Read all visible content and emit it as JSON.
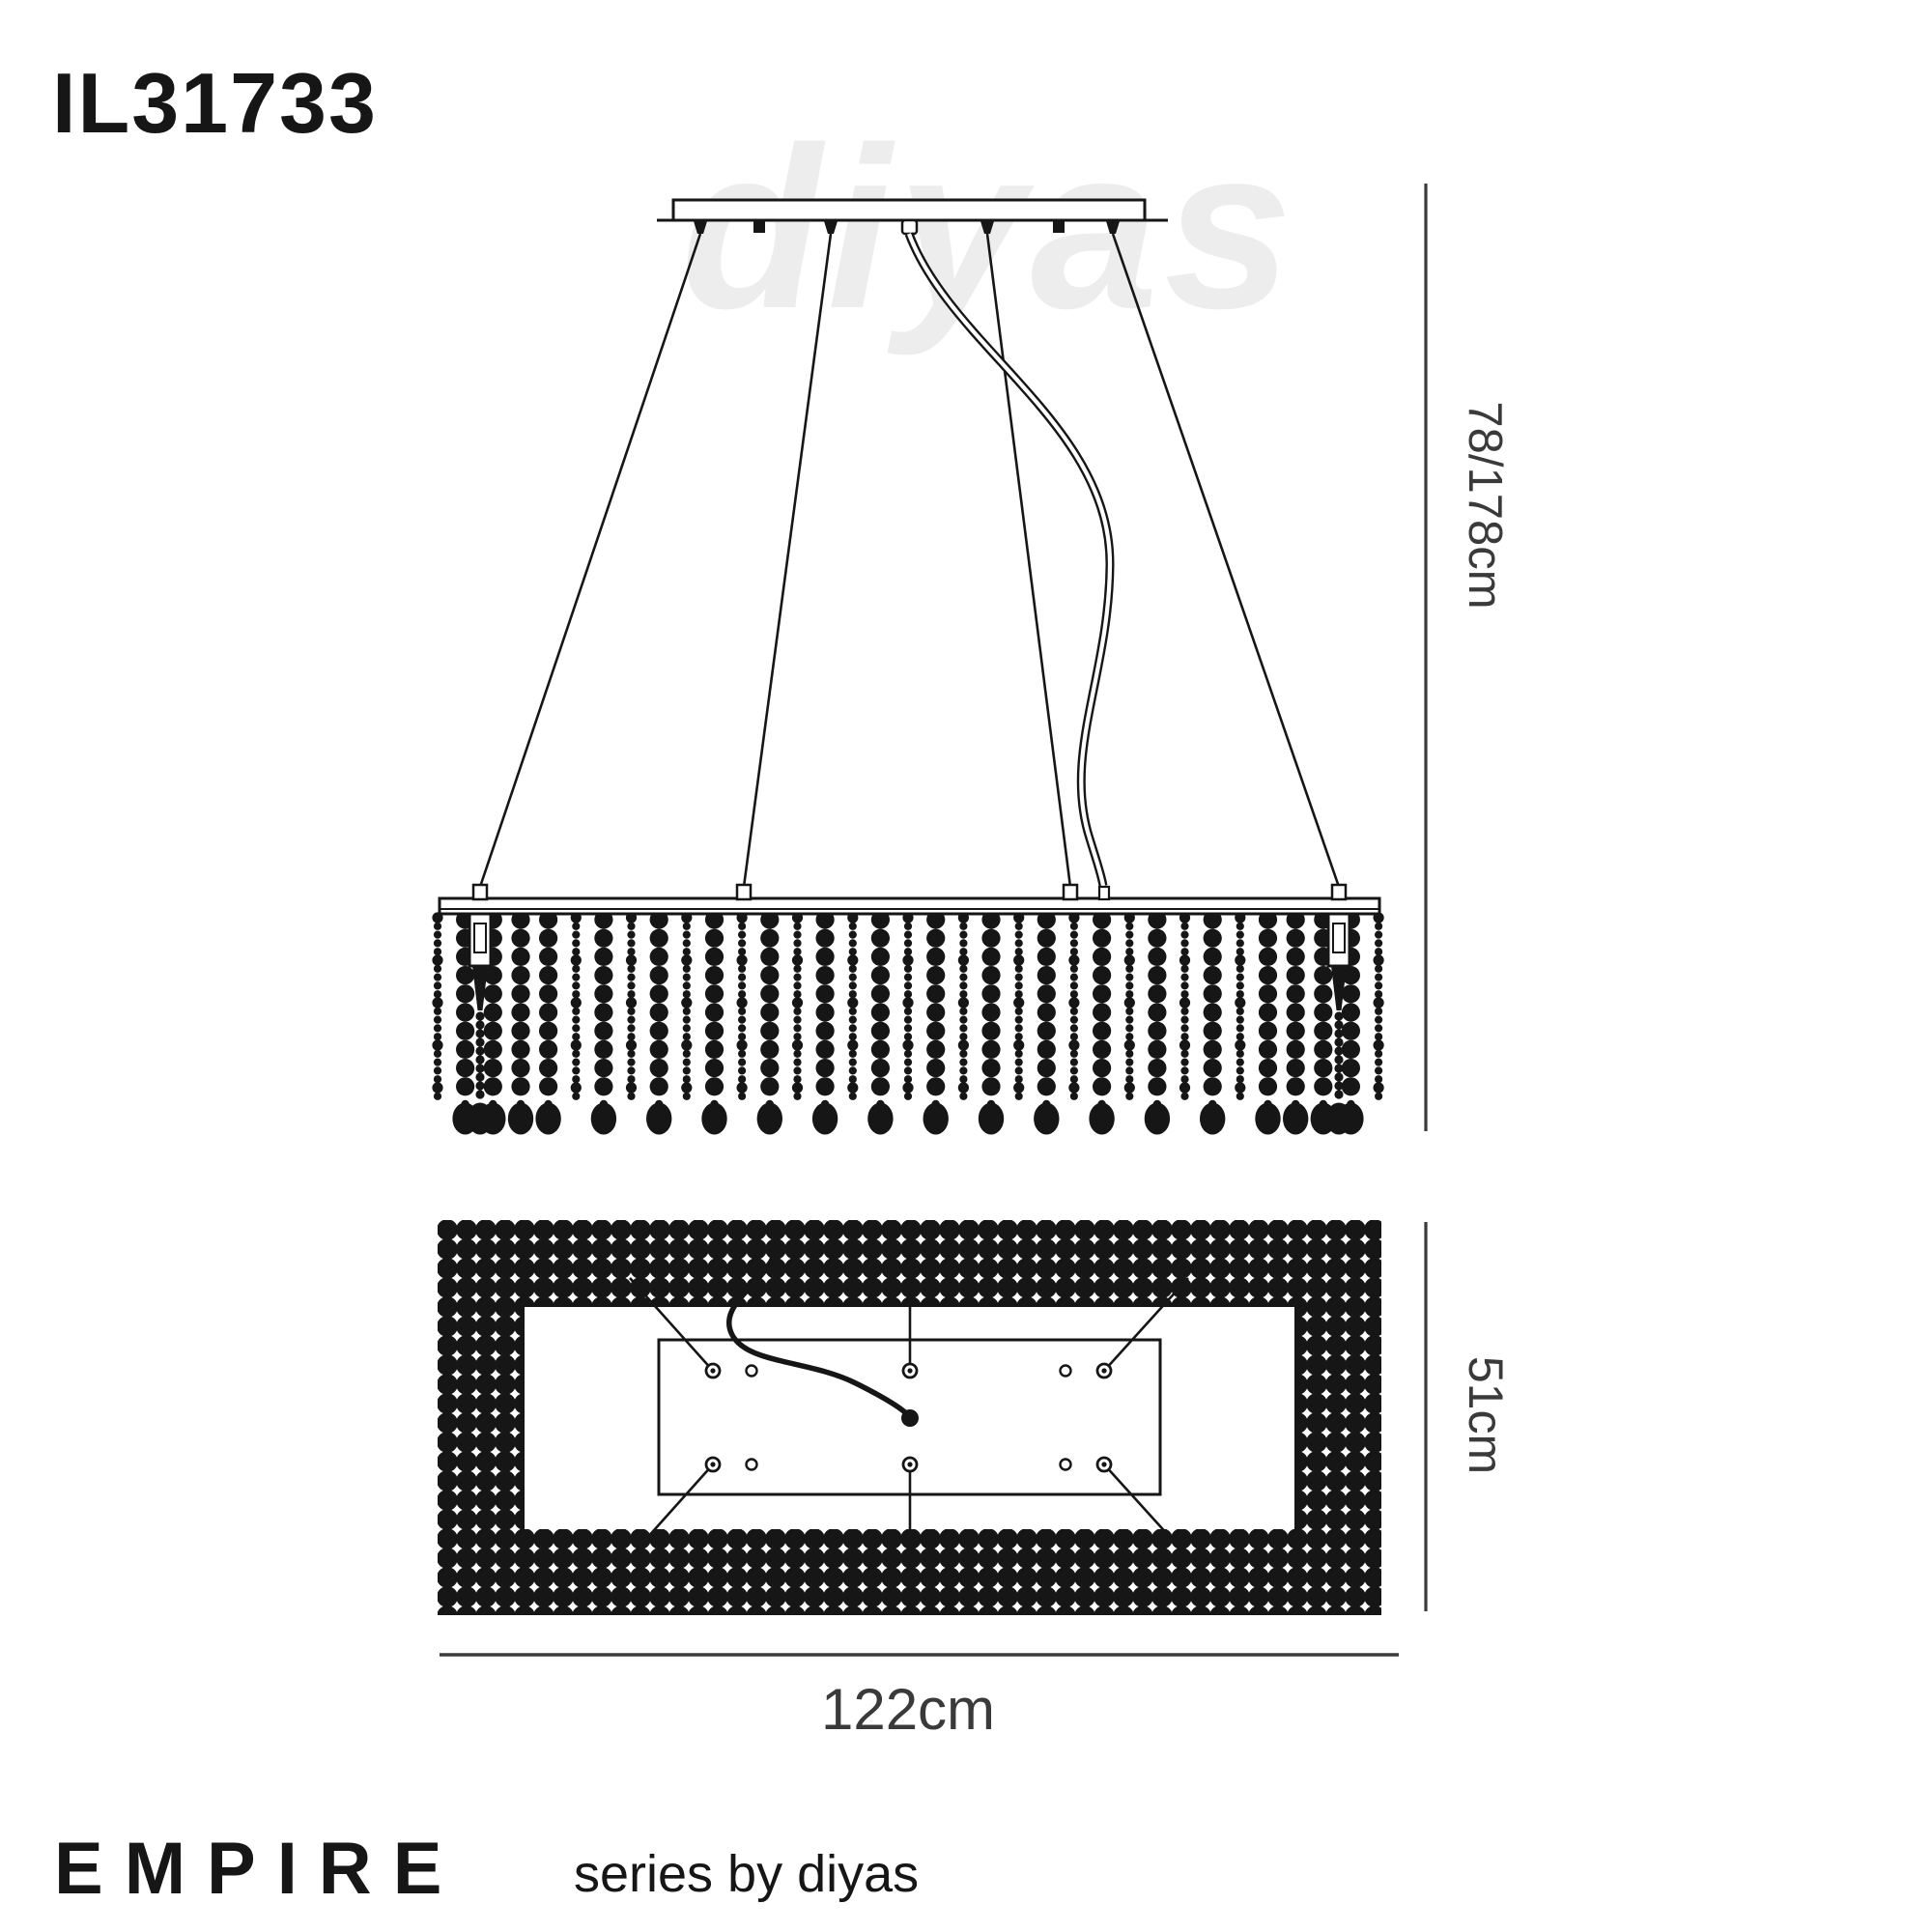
{
  "product": {
    "code": "IL31733"
  },
  "watermark": {
    "text": "diyas"
  },
  "dimensions": {
    "height": {
      "label": "78/178cm"
    },
    "depth": {
      "label": "51cm"
    },
    "width": {
      "label": "122cm"
    }
  },
  "footer": {
    "series": "EMPIRE",
    "byline": "series by diyas"
  },
  "drawing": {
    "view_names": [
      "side-elevation",
      "plan"
    ],
    "suspension_wire_count": 4,
    "lamp_socket_count": 2,
    "bead_strand_count": 35,
    "plan_hole_rows": 2,
    "plan_holes_per_row": 5
  },
  "colors": {
    "ink": "#161616",
    "dimension": "#3a3a3a",
    "watermark": "#ededed",
    "background": "#ffffff"
  }
}
